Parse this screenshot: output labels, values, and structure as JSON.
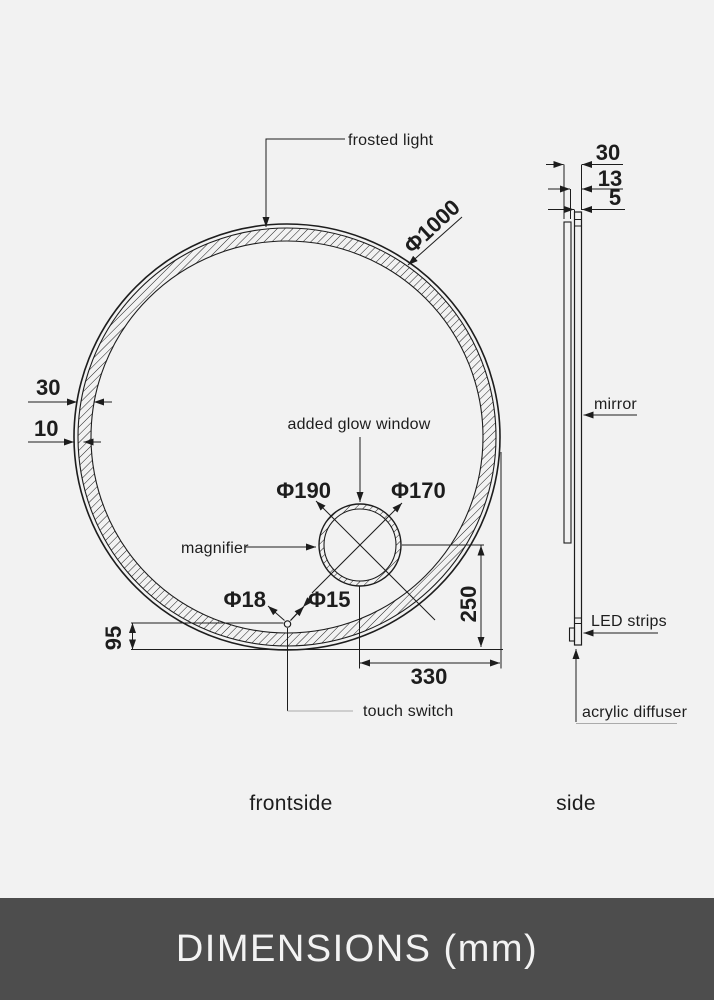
{
  "colors": {
    "background": "#f2f2f2",
    "line": "#1d1d1d",
    "footer_background": "#4d4d4d",
    "footer_text": "#f3f3f3"
  },
  "front_view": {
    "caption": "frontside",
    "labels": {
      "frosted_light": "frosted light",
      "added_glow_window": "added glow window",
      "magnifier": "magnifier",
      "touch_switch": "touch switch"
    },
    "dims": {
      "diameter": "Φ1000",
      "ring_width": "30",
      "frost_inset": "10",
      "magnifier_outer_diameter": "Φ190",
      "magnifier_inner_diameter": "Φ170",
      "touch_switch_outer_diameter": "Φ18",
      "touch_switch_inner_diameter": "Φ15",
      "switch_bottom_offset": "95",
      "magnifier_bottom_offset": "250",
      "magnifier_right_offset": "330"
    }
  },
  "side_view": {
    "caption": "side",
    "labels": {
      "mirror": "mirror",
      "led_strips": "LED strips",
      "acrylic_diffuser": "acrylic diffuser"
    },
    "dims": {
      "total_depth": "30",
      "body_depth": "13",
      "glass_depth": "5"
    }
  },
  "footer": {
    "title": "DIMENSIONS (mm)"
  }
}
